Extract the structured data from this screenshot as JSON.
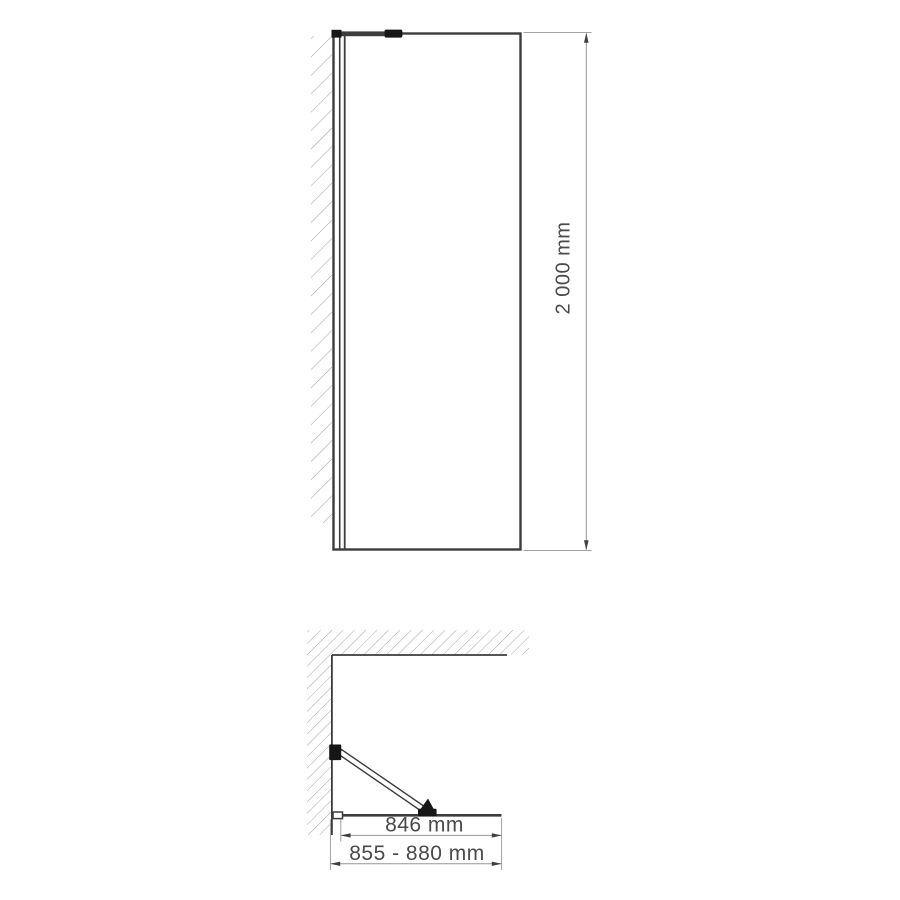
{
  "colors": {
    "background": "#ffffff",
    "outline": "#3c3c3c",
    "fitting": "#161616",
    "dimension": "#969696",
    "arrow": "#3f3f3f",
    "text": "#4a4a4a",
    "hatch": "#a5a5a5",
    "glass": "#ffffff"
  },
  "front_view": {
    "height_dimension": {
      "label": "2 000 mm"
    }
  },
  "plan_view": {
    "glass_width_dimension": {
      "label": "846 mm"
    },
    "total_width_dimension": {
      "label": "855 - 880 mm"
    }
  }
}
